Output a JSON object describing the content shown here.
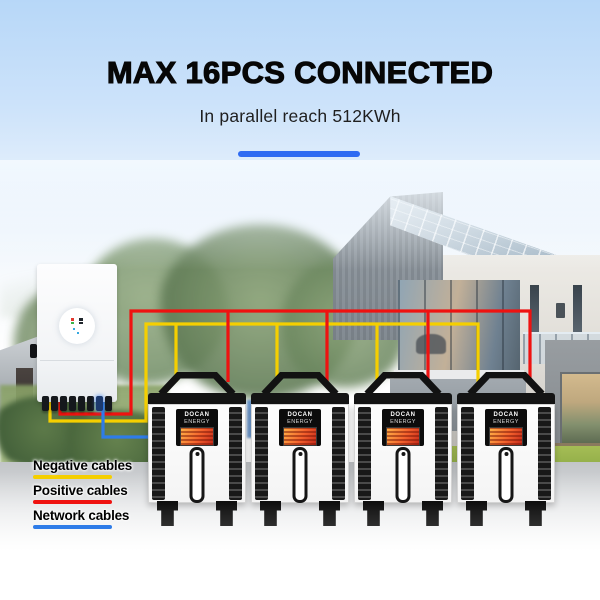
{
  "header": {
    "title": "MAX 16PCS CONNECTED",
    "subtitle": "In parallel reach 512KWh"
  },
  "legend": [
    {
      "label": "Negative cables",
      "color": "#F5CF00"
    },
    {
      "label": "Positive cables",
      "color": "#EF1210"
    },
    {
      "label": "Network cables",
      "color": "#2E7CE8"
    }
  ],
  "battery": {
    "count": 4,
    "brand_line1": "DOCAN",
    "brand_line2": "ENERGY"
  },
  "colors": {
    "negative": "#F5CF00",
    "positive": "#EF1210",
    "network": "#2E7CE8",
    "accent": "#2F6BF2"
  }
}
